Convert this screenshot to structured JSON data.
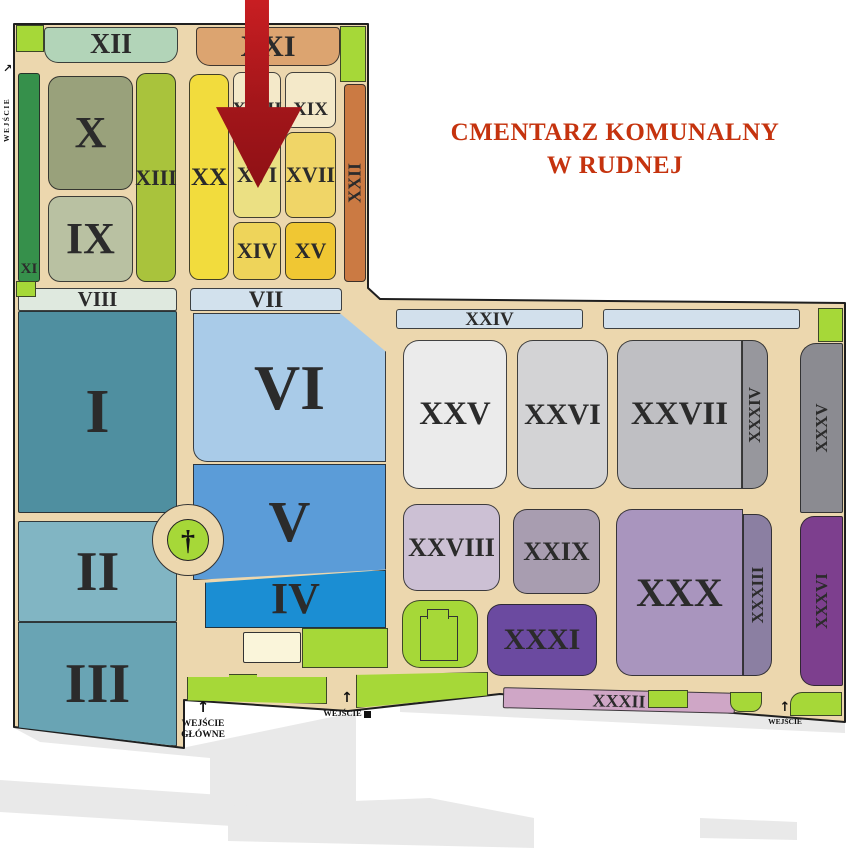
{
  "title": {
    "line1": "CMENTARZ KOMUNALNY",
    "line2": "W RUDNEJ"
  },
  "sections": {
    "I": "I",
    "II": "II",
    "III": "III",
    "IV": "IV",
    "V": "V",
    "VI": "VI",
    "VII": "VII",
    "VIII": "VIII",
    "IX": "IX",
    "X": "X",
    "XI": "XI",
    "XII": "XII",
    "XIII": "XIII",
    "XIV": "XIV",
    "XV": "XV",
    "XVI": "XVI",
    "XVII": "XVII",
    "XVIII": "XVIII",
    "XIX": "XIX",
    "XX": "XX",
    "XXI": "XXI",
    "XXII": "XXII",
    "XXIV": "XXIV",
    "XXV": "XXV",
    "XXVI": "XXVI",
    "XXVII": "XXVII",
    "XXVIII": "XXVIII",
    "XXIX": "XXIX",
    "XXX": "XXX",
    "XXXI": "XXXI",
    "XXXII": "XXXII",
    "XXXIII": "XXXIII",
    "XXXIV": "XXXIV",
    "XXXV": "XXXV",
    "XXXVI": "XXXVI"
  },
  "entrances": {
    "main": {
      "arrow": "↑",
      "line1": "WEJŚCIE",
      "line2": "GŁÓWNE"
    },
    "south": {
      "arrow": "↑",
      "label": "WEJŚCIE"
    },
    "southeast": {
      "arrow": "↑",
      "label": "WEJŚCIE"
    },
    "west": {
      "arrow": "↗",
      "label": "WEJŚCIE"
    }
  },
  "symbols": {
    "cross": "†"
  },
  "colors": {
    "title": "#c5330e",
    "road": "#ecd7ae",
    "outline": "#1f1f1f",
    "outside": "#e9e9e9",
    "green": "#a6d838",
    "building": "#faf5da",
    "arrow_gradient": "linear-gradient(180deg,#c81e22 0%,#a3161a 55%,#8e1015 100%)",
    "sections": {
      "I": "#4f8fa0",
      "II": "#81b5c3",
      "III": "#69a4b4",
      "IV": "#1b8ed3",
      "V": "#5b9cd8",
      "VI": "#a9cbe8",
      "VII": "#d2e1ed",
      "VIII": "#dfe9df",
      "IX": "#b9c1a2",
      "X": "#99a17b",
      "XI": "#36904b",
      "XII": "#b2d4b8",
      "XIII": "#a9c33c",
      "XIV": "#eed45a",
      "XV": "#f0c733",
      "XVI": "#ebe083",
      "XVII": "#f0d567",
      "XVIII": "#f4e9c9",
      "XIX": "#f4e9c9",
      "XX": "#f2dc3d",
      "XXI": "#dca470",
      "XXII": "#cb7a43",
      "XXIV": "#d2e0ec",
      "XXV": "#ebebeb",
      "XXVI": "#d3d3d5",
      "XXVII": "#bfbfc3",
      "XXVIII": "#ccc0d4",
      "XXIX": "#a89db0",
      "XXX": "#a995be",
      "XXXI": "#6b4aa0",
      "XXXII": "#cfa6c6",
      "XXXIII": "#8b7fa2",
      "XXXIV": "#97979d",
      "XXXV": "#8b8b91",
      "XXXVI": "#7d3f8e"
    }
  }
}
